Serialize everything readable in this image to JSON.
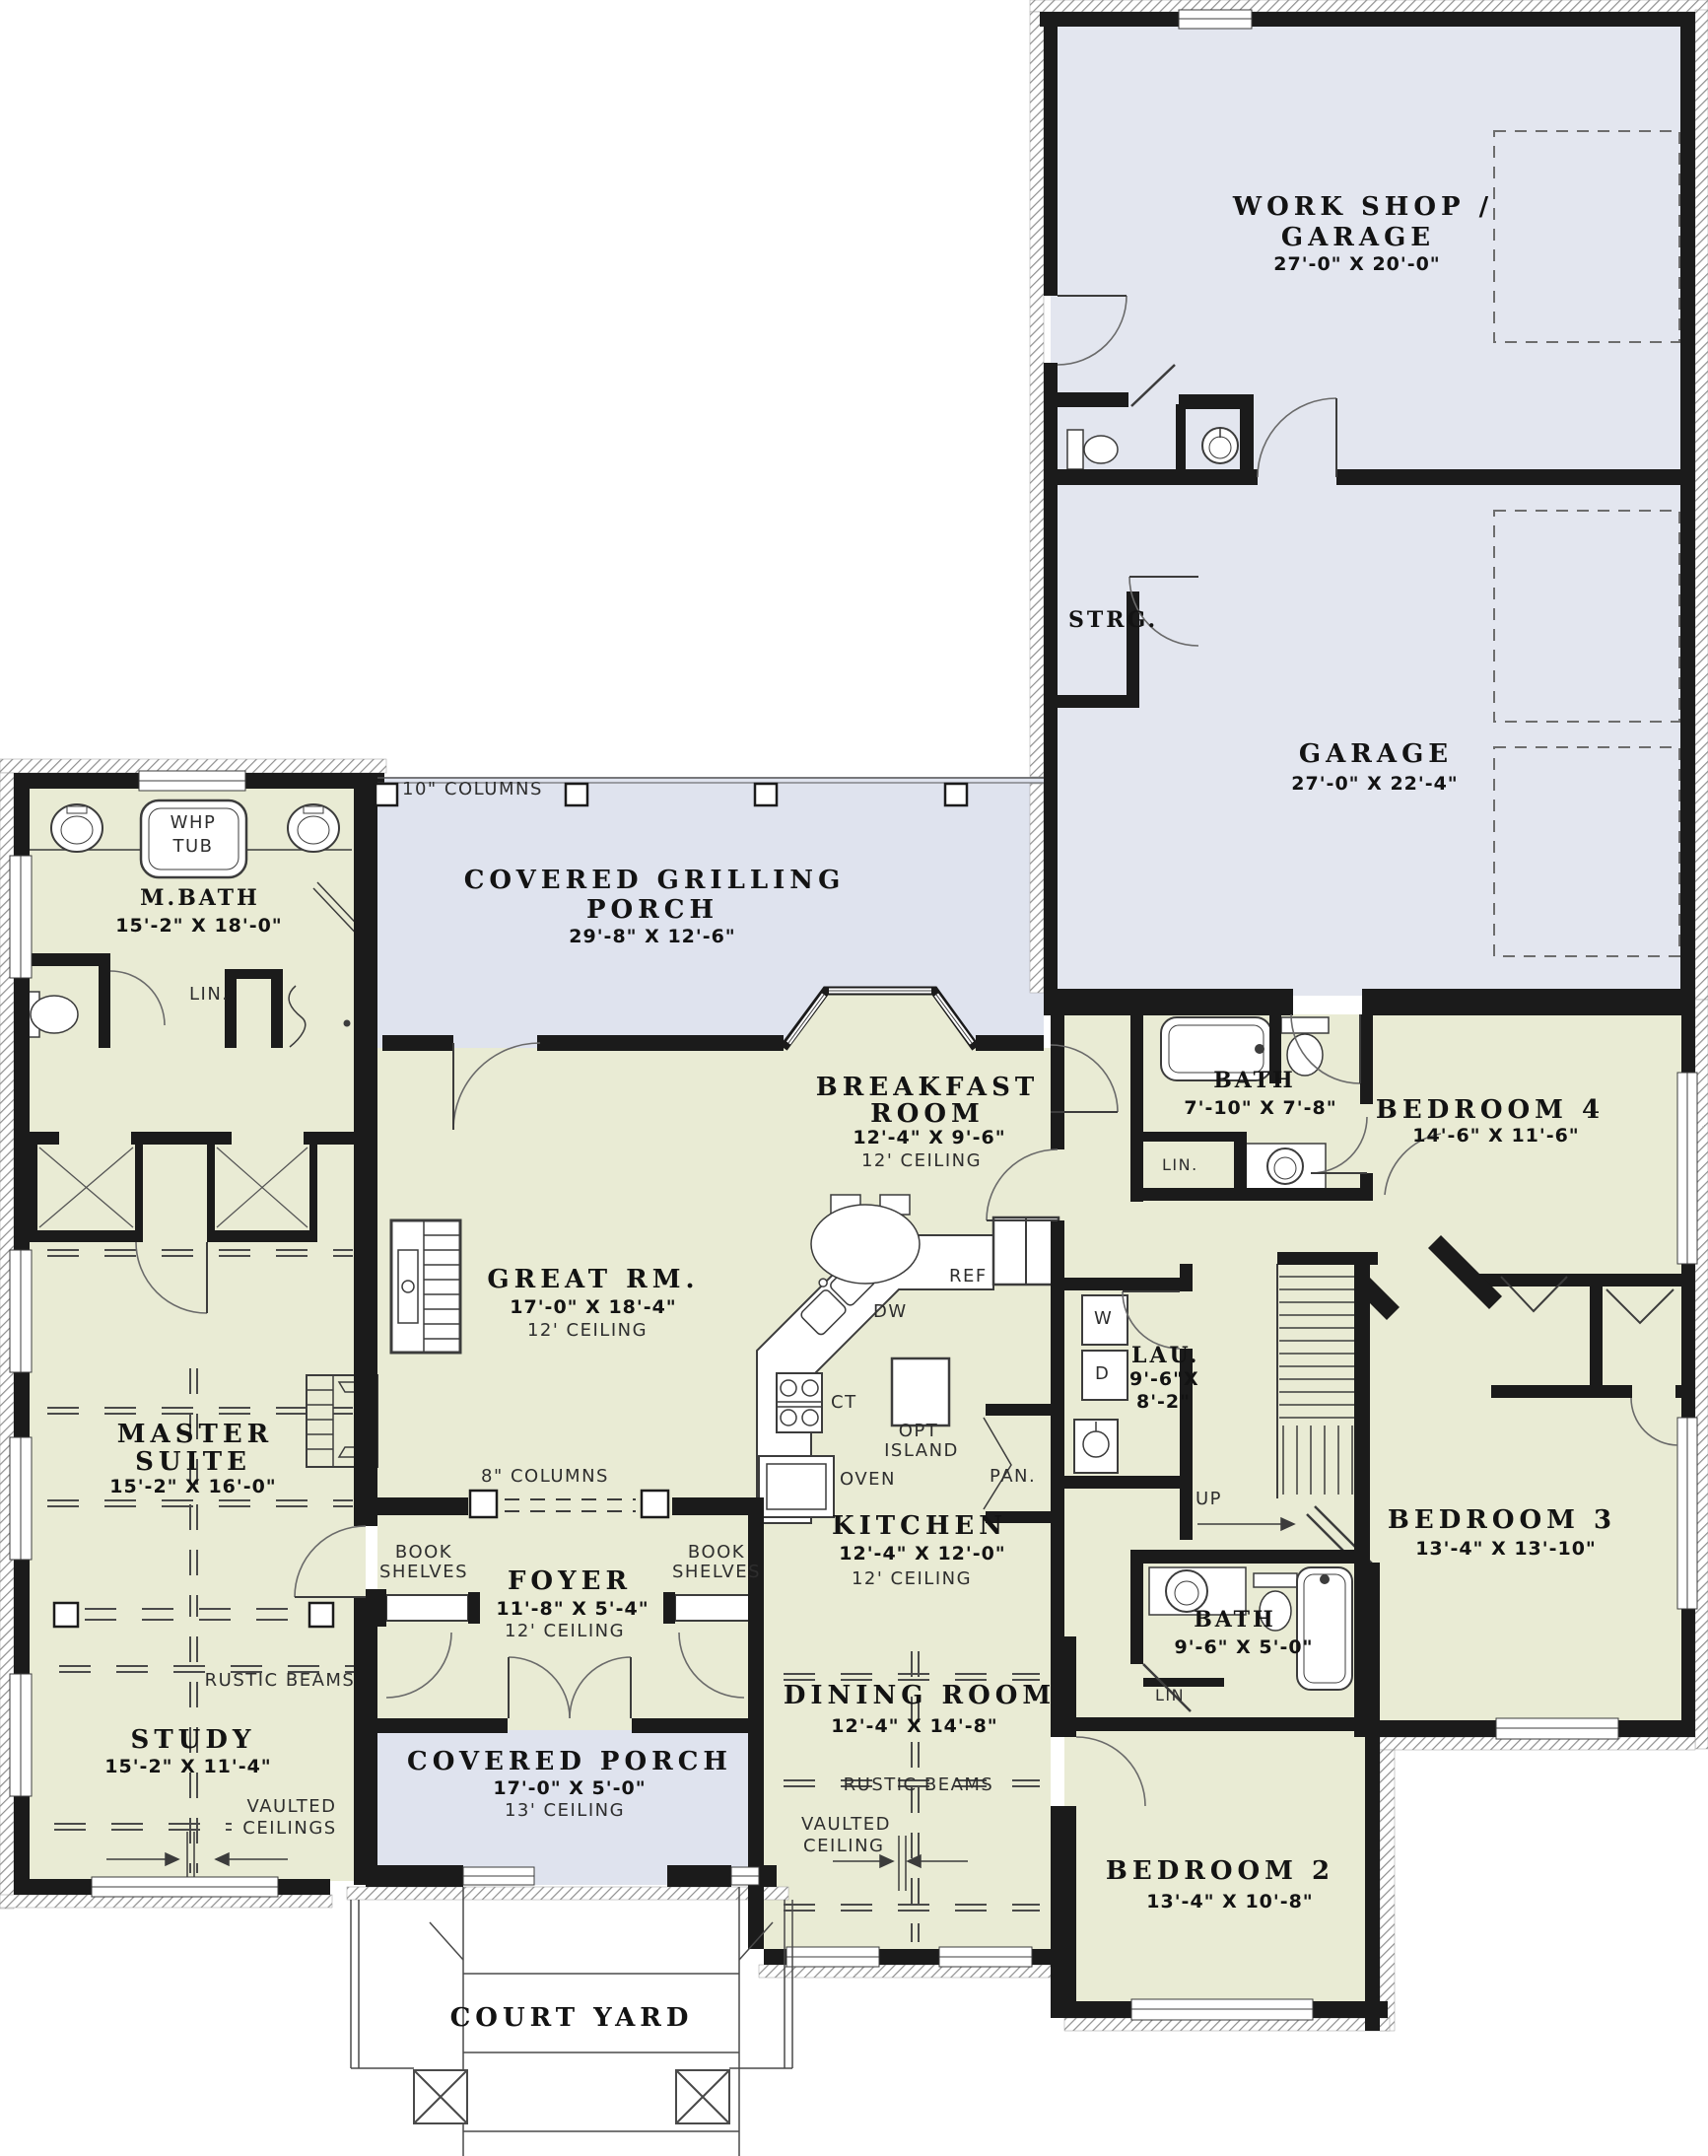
{
  "plan": {
    "colors": {
      "wall": "#1b1b1b",
      "living_fill": "#e9ebd4",
      "garage_fill": "#e3e6ef",
      "porch_fill": "#dfe3ee",
      "line": "#3c3c3c"
    },
    "rooms": {
      "workshop": {
        "line1": "WORK SHOP /",
        "line2": "GARAGE",
        "dims": "27'-0\" X 20'-0\""
      },
      "garage": {
        "line1": "GARAGE",
        "dims": "27'-0\" X 22'-4\""
      },
      "strg": {
        "line1": "STRG."
      },
      "grilling_porch": {
        "line1": "COVERED GRILLING",
        "line2": "PORCH",
        "dims": "29'-8\" X 12'-6\""
      },
      "mbath": {
        "line1": "M.BATH",
        "dims": "15'-2\" X 18'-0\""
      },
      "master": {
        "line1": "MASTER",
        "line2": "SUITE",
        "dims": "15'-2\" X 16'-0\""
      },
      "study": {
        "line1": "STUDY",
        "dims": "15'-2\" X 11'-4\""
      },
      "great": {
        "line1": "GREAT RM.",
        "dims": "17'-0\" X 18'-4\"",
        "ceiling": "12' CEILING"
      },
      "breakfast": {
        "line1": "BREAKFAST",
        "line2": "ROOM",
        "dims": "12'-4\" X 9'-6\"",
        "ceiling": "12' CEILING"
      },
      "kitchen": {
        "line1": "KITCHEN",
        "dims": "12'-4\" X 12'-0\"",
        "ceiling": "12' CEILING"
      },
      "laundry": {
        "line1": "LAU.",
        "dims_line1": "9'-6\"X",
        "dims_line2": "8'-2\""
      },
      "bath4": {
        "line1": "BATH",
        "dims": "7'-10\" X 7'-8\""
      },
      "bed4": {
        "line1": "BEDROOM 4",
        "dims": "14'-6\" X 11'-6\""
      },
      "bed3": {
        "line1": "BEDROOM 3",
        "dims": "13'-4\" X 13'-10\""
      },
      "bath23": {
        "line1": "BATH",
        "dims": "9'-6\" X 5'-0\""
      },
      "bed2": {
        "line1": "BEDROOM 2",
        "dims": "13'-4\" X 10'-8\""
      },
      "dining": {
        "line1": "DINING ROOM",
        "dims": "12'-4\" X 14'-8\""
      },
      "foyer": {
        "line1": "FOYER",
        "dims": "11'-8\" X 5'-4\"",
        "ceiling": "12' CEILING"
      },
      "porch": {
        "line1": "COVERED PORCH",
        "dims": "17'-0\" X 5'-0\"",
        "ceiling": "13' CEILING"
      },
      "courtyard": {
        "line1": "COURT YARD"
      }
    },
    "labels": {
      "whp_line1": "WHP",
      "whp_line2": "TUB",
      "lin_dot": "LIN.",
      "lin": "LIN",
      "ref": "REF",
      "dw": "DW",
      "ct": "CT",
      "oven": "OVEN",
      "opt_line1": "OPT",
      "opt_line2": "ISLAND",
      "pan": "PAN.",
      "washer": "W",
      "dryer": "D",
      "up": "UP",
      "book_line1": "BOOK",
      "book_line2": "SHELVES",
      "columns_10": "10\" COLUMNS",
      "columns_8": "8\" COLUMNS",
      "rustic_beams": "RUSTIC BEAMS",
      "vaulted_line1": "VAULTED",
      "vaulted_ceilings": "CEILINGS",
      "vaulted_ceiling": "CEILING"
    }
  }
}
